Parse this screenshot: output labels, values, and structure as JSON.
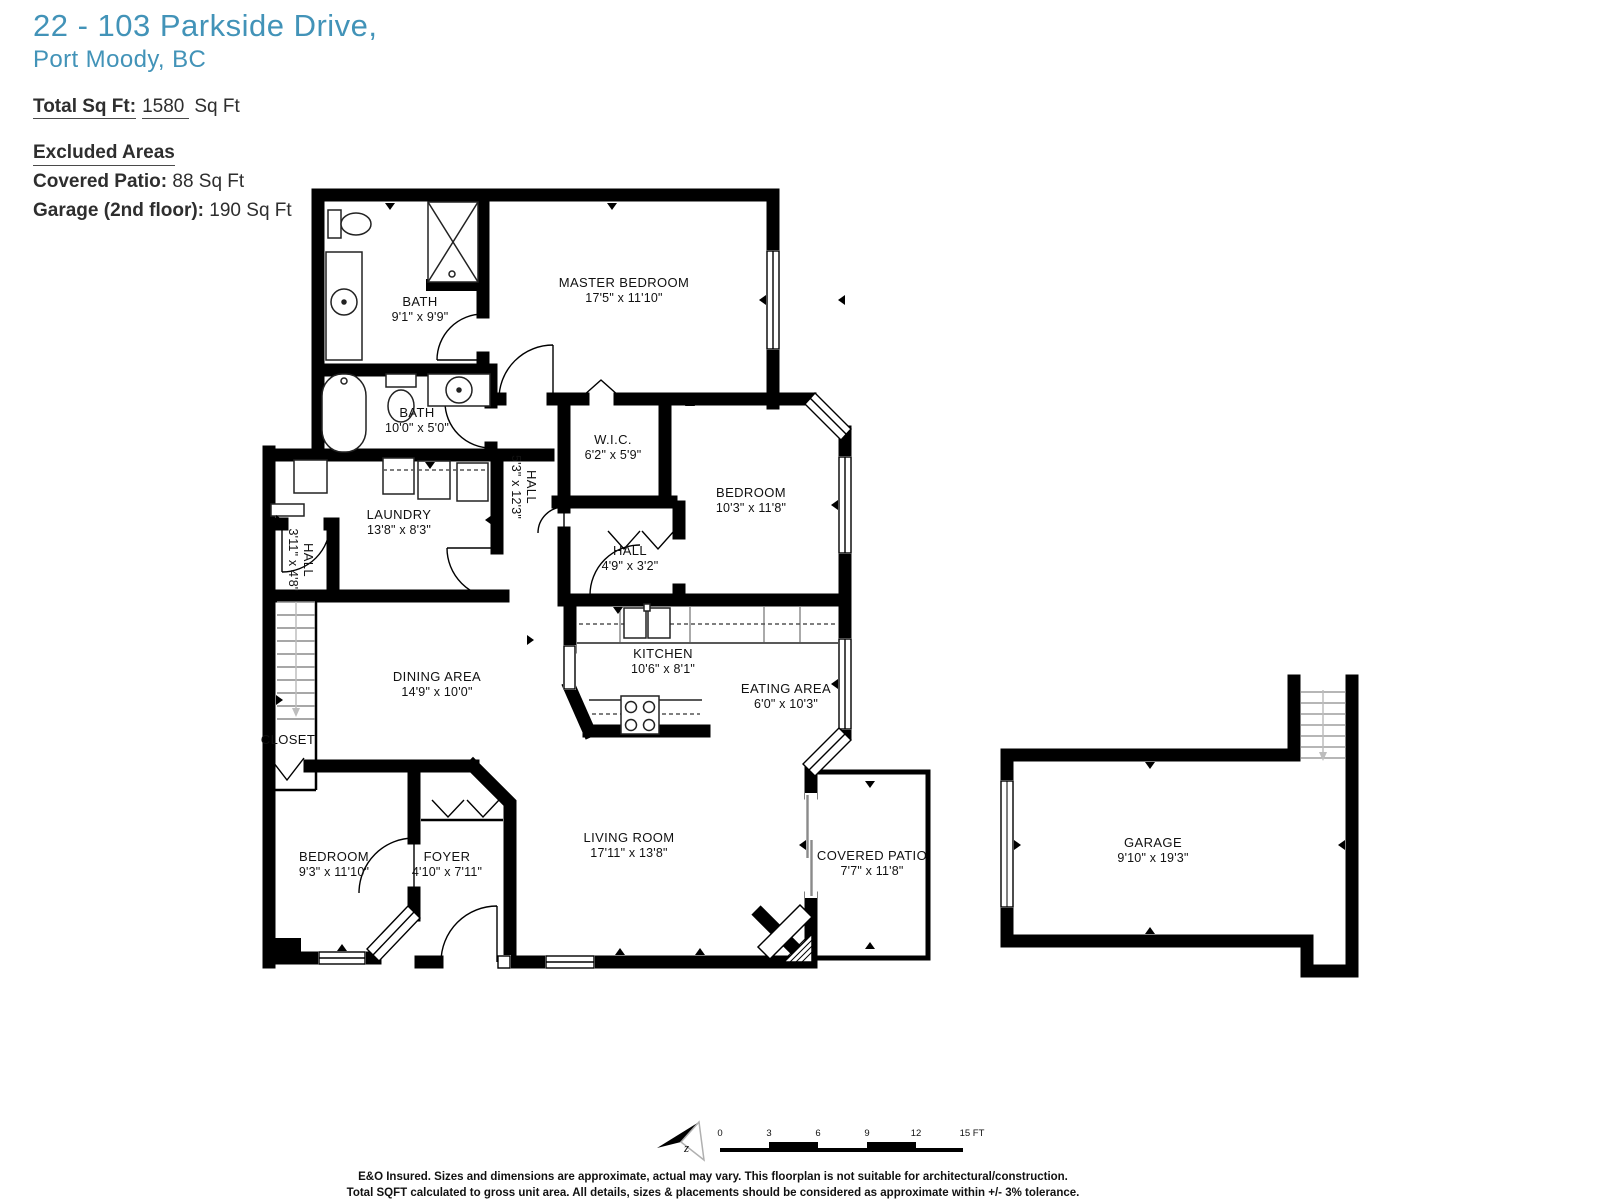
{
  "header": {
    "address_line1": "22 - 103 Parkside Drive,",
    "address_line2": "Port Moody, BC",
    "accent_color": "#4293b8",
    "total": {
      "label": "Total Sq Ft:",
      "value": "1580",
      "unit": "Sq Ft"
    },
    "excluded_title": "Excluded Areas",
    "excluded": [
      {
        "label": "Covered Patio:",
        "value": "88 Sq Ft"
      },
      {
        "label": "Garage (2nd floor):",
        "value": "190 Sq Ft"
      }
    ]
  },
  "floorplan": {
    "rooms": [
      {
        "name": "BATH",
        "dims": "9'1\" x 9'9\"",
        "x": 420,
        "y": 309,
        "rot": 0
      },
      {
        "name": "MASTER BEDROOM",
        "dims": "17'5\" x 11'10\"",
        "x": 624,
        "y": 290,
        "rot": 0
      },
      {
        "name": "BATH",
        "dims": "10'0\" x 5'0\"",
        "x": 417,
        "y": 420,
        "rot": 0
      },
      {
        "name": "W.I.C.",
        "dims": "6'2\" x 5'9\"",
        "x": 613,
        "y": 447,
        "rot": 0
      },
      {
        "name": "HALL",
        "dims": "5'3\" x 12'3\"",
        "x": 524,
        "y": 487,
        "rot": 90
      },
      {
        "name": "BEDROOM",
        "dims": "10'3\" x 11'8\"",
        "x": 751,
        "y": 500,
        "rot": 0
      },
      {
        "name": "LAUNDRY",
        "dims": "13'8\" x 8'3\"",
        "x": 399,
        "y": 522,
        "rot": 0
      },
      {
        "name": "HALL",
        "dims": "3'11\" x 4'8\"",
        "x": 301,
        "y": 560,
        "rot": 90
      },
      {
        "name": "HALL",
        "dims": "4'9\" x 3'2\"",
        "x": 630,
        "y": 558,
        "rot": 0
      },
      {
        "name": "KITCHEN",
        "dims": "10'6\" x 8'1\"",
        "x": 663,
        "y": 661,
        "rot": 0
      },
      {
        "name": "DINING AREA",
        "dims": "14'9\" x 10'0\"",
        "x": 437,
        "y": 684,
        "rot": 0
      },
      {
        "name": "EATING AREA",
        "dims": "6'0\" x 10'3\"",
        "x": 786,
        "y": 696,
        "rot": 0
      },
      {
        "name": "CLOSET",
        "dims": "",
        "x": 288,
        "y": 740,
        "rot": 0
      },
      {
        "name": "BEDROOM",
        "dims": "9'3\" x 11'10\"",
        "x": 334,
        "y": 864,
        "rot": 0
      },
      {
        "name": "FOYER",
        "dims": "4'10\" x 7'11\"",
        "x": 447,
        "y": 864,
        "rot": 0
      },
      {
        "name": "LIVING ROOM",
        "dims": "17'11\" x 13'8\"",
        "x": 629,
        "y": 845,
        "rot": 0
      },
      {
        "name": "COVERED PATIO",
        "dims": "7'7\" x 11'8\"",
        "x": 872,
        "y": 863,
        "rot": 0
      },
      {
        "name": "GARAGE",
        "dims": "9'10\" x 19'3\"",
        "x": 1153,
        "y": 850,
        "rot": 0
      }
    ]
  },
  "scalebar": {
    "ticks": [
      "0",
      "3",
      "6",
      "9",
      "12",
      "15 FT"
    ],
    "positions": [
      720,
      769,
      818,
      867,
      916,
      972
    ]
  },
  "compass": {
    "letter": "z"
  },
  "footer": {
    "line1": "E&O Insured. Sizes and dimensions are approximate, actual may vary. This floorplan is not suitable for architectural/construction.",
    "line2": "Total SQFT calculated to gross unit area. All details, sizes & placements should be considered as approximate within +/- 3% tolerance."
  }
}
